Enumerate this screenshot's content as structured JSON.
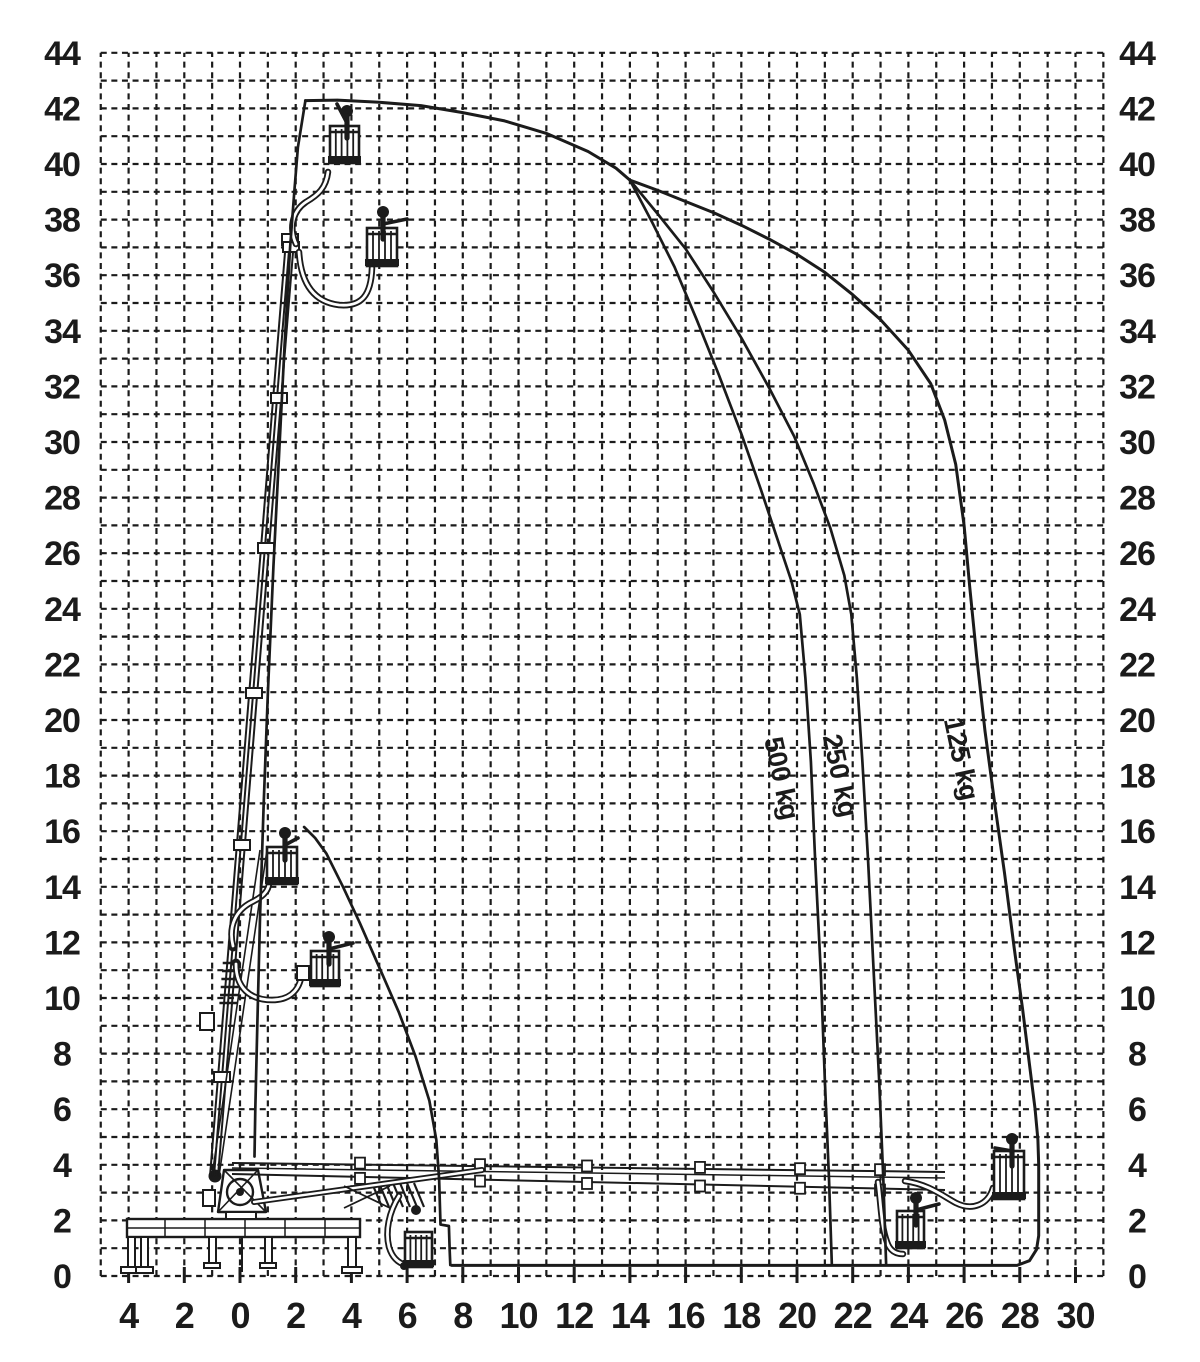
{
  "chart_data": {
    "type": "line",
    "title": "",
    "xlabel": "",
    "ylabel": "",
    "grid": "dashed",
    "background": "#ffffff",
    "ink_color": "#1b1b1b",
    "x_axis": {
      "min": -5,
      "max": 31,
      "grid_step": 1,
      "label_step": 2,
      "label_values": [
        -4,
        -2,
        0,
        2,
        4,
        6,
        8,
        10,
        12,
        14,
        16,
        18,
        20,
        22,
        24,
        26,
        28,
        30
      ],
      "tick_labels": [
        "4",
        "2",
        "0",
        "2",
        "4",
        "6",
        "8",
        "10",
        "12",
        "14",
        "16",
        "18",
        "20",
        "22",
        "24",
        "26",
        "28",
        "30"
      ]
    },
    "y_axis": {
      "min": 0,
      "max": 44,
      "grid_step": 1,
      "label_step": 2,
      "labels_both_sides": true,
      "label_values": [
        0,
        2,
        4,
        6,
        8,
        10,
        12,
        14,
        16,
        18,
        20,
        22,
        24,
        26,
        28,
        30,
        32,
        34,
        36,
        38,
        40,
        42,
        44
      ],
      "tick_labels": [
        "0",
        "2",
        "4",
        "6",
        "8",
        "10",
        "12",
        "14",
        "16",
        "18",
        "20",
        "22",
        "24",
        "26",
        "28",
        "30",
        "32",
        "34",
        "36",
        "38",
        "40",
        "42",
        "44"
      ]
    },
    "series": [
      {
        "name": "envelope-125kg-outer",
        "label": "125 kg",
        "points": [
          [
            2.35,
            42.28
          ],
          [
            3.5,
            42.3
          ],
          [
            5,
            42.22
          ],
          [
            6.5,
            42.1
          ],
          [
            8,
            41.85
          ],
          [
            9.5,
            41.55
          ],
          [
            11,
            41.1
          ],
          [
            12.5,
            40.45
          ],
          [
            13.5,
            39.85
          ],
          [
            14,
            39.42
          ],
          [
            15,
            39.05
          ],
          [
            16,
            38.65
          ],
          [
            17,
            38.25
          ],
          [
            18,
            37.8
          ],
          [
            19,
            37.3
          ],
          [
            20,
            36.75
          ],
          [
            21,
            36.1
          ],
          [
            22,
            35.3
          ],
          [
            23,
            34.4
          ],
          [
            24,
            33.3
          ],
          [
            24.8,
            32.1
          ],
          [
            25.3,
            30.8
          ],
          [
            25.7,
            29.2
          ],
          [
            26.0,
            27.0
          ],
          [
            26.2,
            24.8
          ],
          [
            26.45,
            22.3
          ],
          [
            26.75,
            19.6
          ],
          [
            27.1,
            17.0
          ],
          [
            27.45,
            14.5
          ],
          [
            27.8,
            11.8
          ],
          [
            28.1,
            9.6
          ],
          [
            28.35,
            7.6
          ],
          [
            28.55,
            6.0
          ],
          [
            28.65,
            4.9
          ],
          [
            28.68,
            4.0
          ],
          [
            28.68,
            1.45
          ],
          [
            28.6,
            0.95
          ],
          [
            28.35,
            0.55
          ],
          [
            27.9,
            0.38
          ],
          [
            24,
            0.38
          ],
          [
            18,
            0.38
          ],
          [
            12,
            0.38
          ],
          [
            7.6,
            0.38
          ]
        ]
      },
      {
        "name": "envelope-250kg",
        "label": "250 kg",
        "points": [
          [
            14,
            39.42
          ],
          [
            15,
            38.2
          ],
          [
            16,
            36.95
          ],
          [
            17,
            35.4
          ],
          [
            18,
            33.75
          ],
          [
            19,
            31.95
          ],
          [
            19.9,
            30.2
          ],
          [
            20.6,
            28.5
          ],
          [
            21.2,
            26.9
          ],
          [
            21.7,
            25.2
          ],
          [
            21.95,
            23.8
          ],
          [
            22.15,
            21.5
          ],
          [
            22.35,
            18.5
          ],
          [
            22.55,
            15.0
          ],
          [
            22.75,
            11.0
          ],
          [
            22.95,
            7.0
          ],
          [
            23.1,
            3.5
          ],
          [
            23.2,
            0.45
          ]
        ]
      },
      {
        "name": "envelope-500kg",
        "label": "500 kg",
        "points": [
          [
            14,
            39.42
          ],
          [
            14.8,
            37.9
          ],
          [
            15.6,
            36.3
          ],
          [
            16.4,
            34.4
          ],
          [
            17.2,
            32.4
          ],
          [
            18.0,
            30.3
          ],
          [
            18.7,
            28.3
          ],
          [
            19.3,
            26.5
          ],
          [
            19.8,
            25.0
          ],
          [
            20.1,
            23.8
          ],
          [
            20.3,
            21.5
          ],
          [
            20.5,
            18.5
          ],
          [
            20.65,
            15.0
          ],
          [
            20.85,
            11.0
          ],
          [
            21.0,
            7.0
          ],
          [
            21.15,
            3.5
          ],
          [
            21.25,
            0.45
          ]
        ]
      },
      {
        "name": "envelope-inner-boundary",
        "label": "",
        "points": [
          [
            2.3,
            16.15
          ],
          [
            2.7,
            15.75
          ],
          [
            3.1,
            15.2
          ],
          [
            3.7,
            14.0
          ],
          [
            4.3,
            12.7
          ],
          [
            5.0,
            11.1
          ],
          [
            5.7,
            9.5
          ],
          [
            6.3,
            7.9
          ],
          [
            6.8,
            6.3
          ],
          [
            7.05,
            4.9
          ],
          [
            7.15,
            3.5
          ],
          [
            7.2,
            1.85
          ],
          [
            7.5,
            1.8
          ],
          [
            7.53,
            0.9
          ],
          [
            7.55,
            0.4
          ]
        ]
      },
      {
        "name": "envelope-left-edge",
        "label": "",
        "points": [
          [
            2.35,
            42.28
          ],
          [
            2.08,
            40.6
          ],
          [
            1.95,
            39.0
          ],
          [
            1.8,
            37.0
          ],
          [
            1.6,
            33.5
          ],
          [
            1.4,
            29.5
          ],
          [
            1.2,
            25.5
          ],
          [
            1.0,
            21.0
          ],
          [
            0.85,
            17.0
          ],
          [
            0.72,
            13.0
          ],
          [
            0.62,
            9.0
          ],
          [
            0.55,
            6.0
          ],
          [
            0.52,
            4.3
          ]
        ]
      }
    ],
    "curve_labels": [
      {
        "text": "500 kg",
        "x": 19.45,
        "y": 17.9,
        "rotation_deg": 78
      },
      {
        "text": "250 kg",
        "x": 21.55,
        "y": 18.0,
        "rotation_deg": 78
      },
      {
        "text": "125 kg",
        "x": 25.9,
        "y": 18.6,
        "rotation_deg": 78
      }
    ]
  }
}
